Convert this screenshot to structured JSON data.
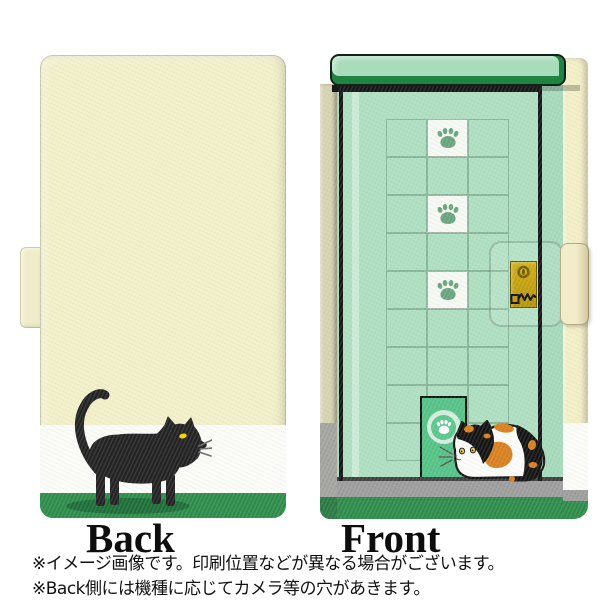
{
  "views": {
    "back": {
      "label": "Back",
      "illustration": "black-cat-walking-with-shadow",
      "stripe_colors": [
        "#f2f0c9",
        "#fbfbf8",
        "#2e8c4b"
      ]
    },
    "front": {
      "label": "Front",
      "illustration": "calico-cat-lying-by-cat-door",
      "paw_tile_count": 3,
      "elements": [
        "door-header-bar",
        "tile-grid",
        "paw-tiles",
        "cat-door",
        "paw-circle",
        "lock-plate",
        "keyhole",
        "key",
        "strap-tab"
      ]
    }
  },
  "disclaimer": {
    "line1": "※イメージ画像です。印刷位置などが異なる場合がございます。",
    "line2": "※Back側には機種に応じてカメラ等の穴があきます。"
  },
  "front_grid": {
    "rows": 9,
    "cols": 3,
    "paw_cells": [
      1,
      7,
      13
    ]
  },
  "colors": {
    "case_cream": "#f2f0c9",
    "stripe_white": "#fbfbf8",
    "stripe_green": "#2e8c4b",
    "cat_shadow_green": "#1d6e39",
    "cat_black": "#232323",
    "eye_yellow": "#f2d600",
    "front_mint": "#a6d9bb",
    "door_mint": "#aedfc1",
    "bar_mint": "#a9dcbb",
    "bar_dark_green": "#1f8342",
    "cat_door_green": "#55c287",
    "paw_green": "#68a57e",
    "tile_white": "#f5f8f3",
    "lock_plate_gold": "#c9a50f",
    "floor_gray": "#9d9d9d",
    "spine_tan": "#d6d3b2",
    "edge_cream": "#f3eec6",
    "calico_orange": "#d8801f"
  }
}
